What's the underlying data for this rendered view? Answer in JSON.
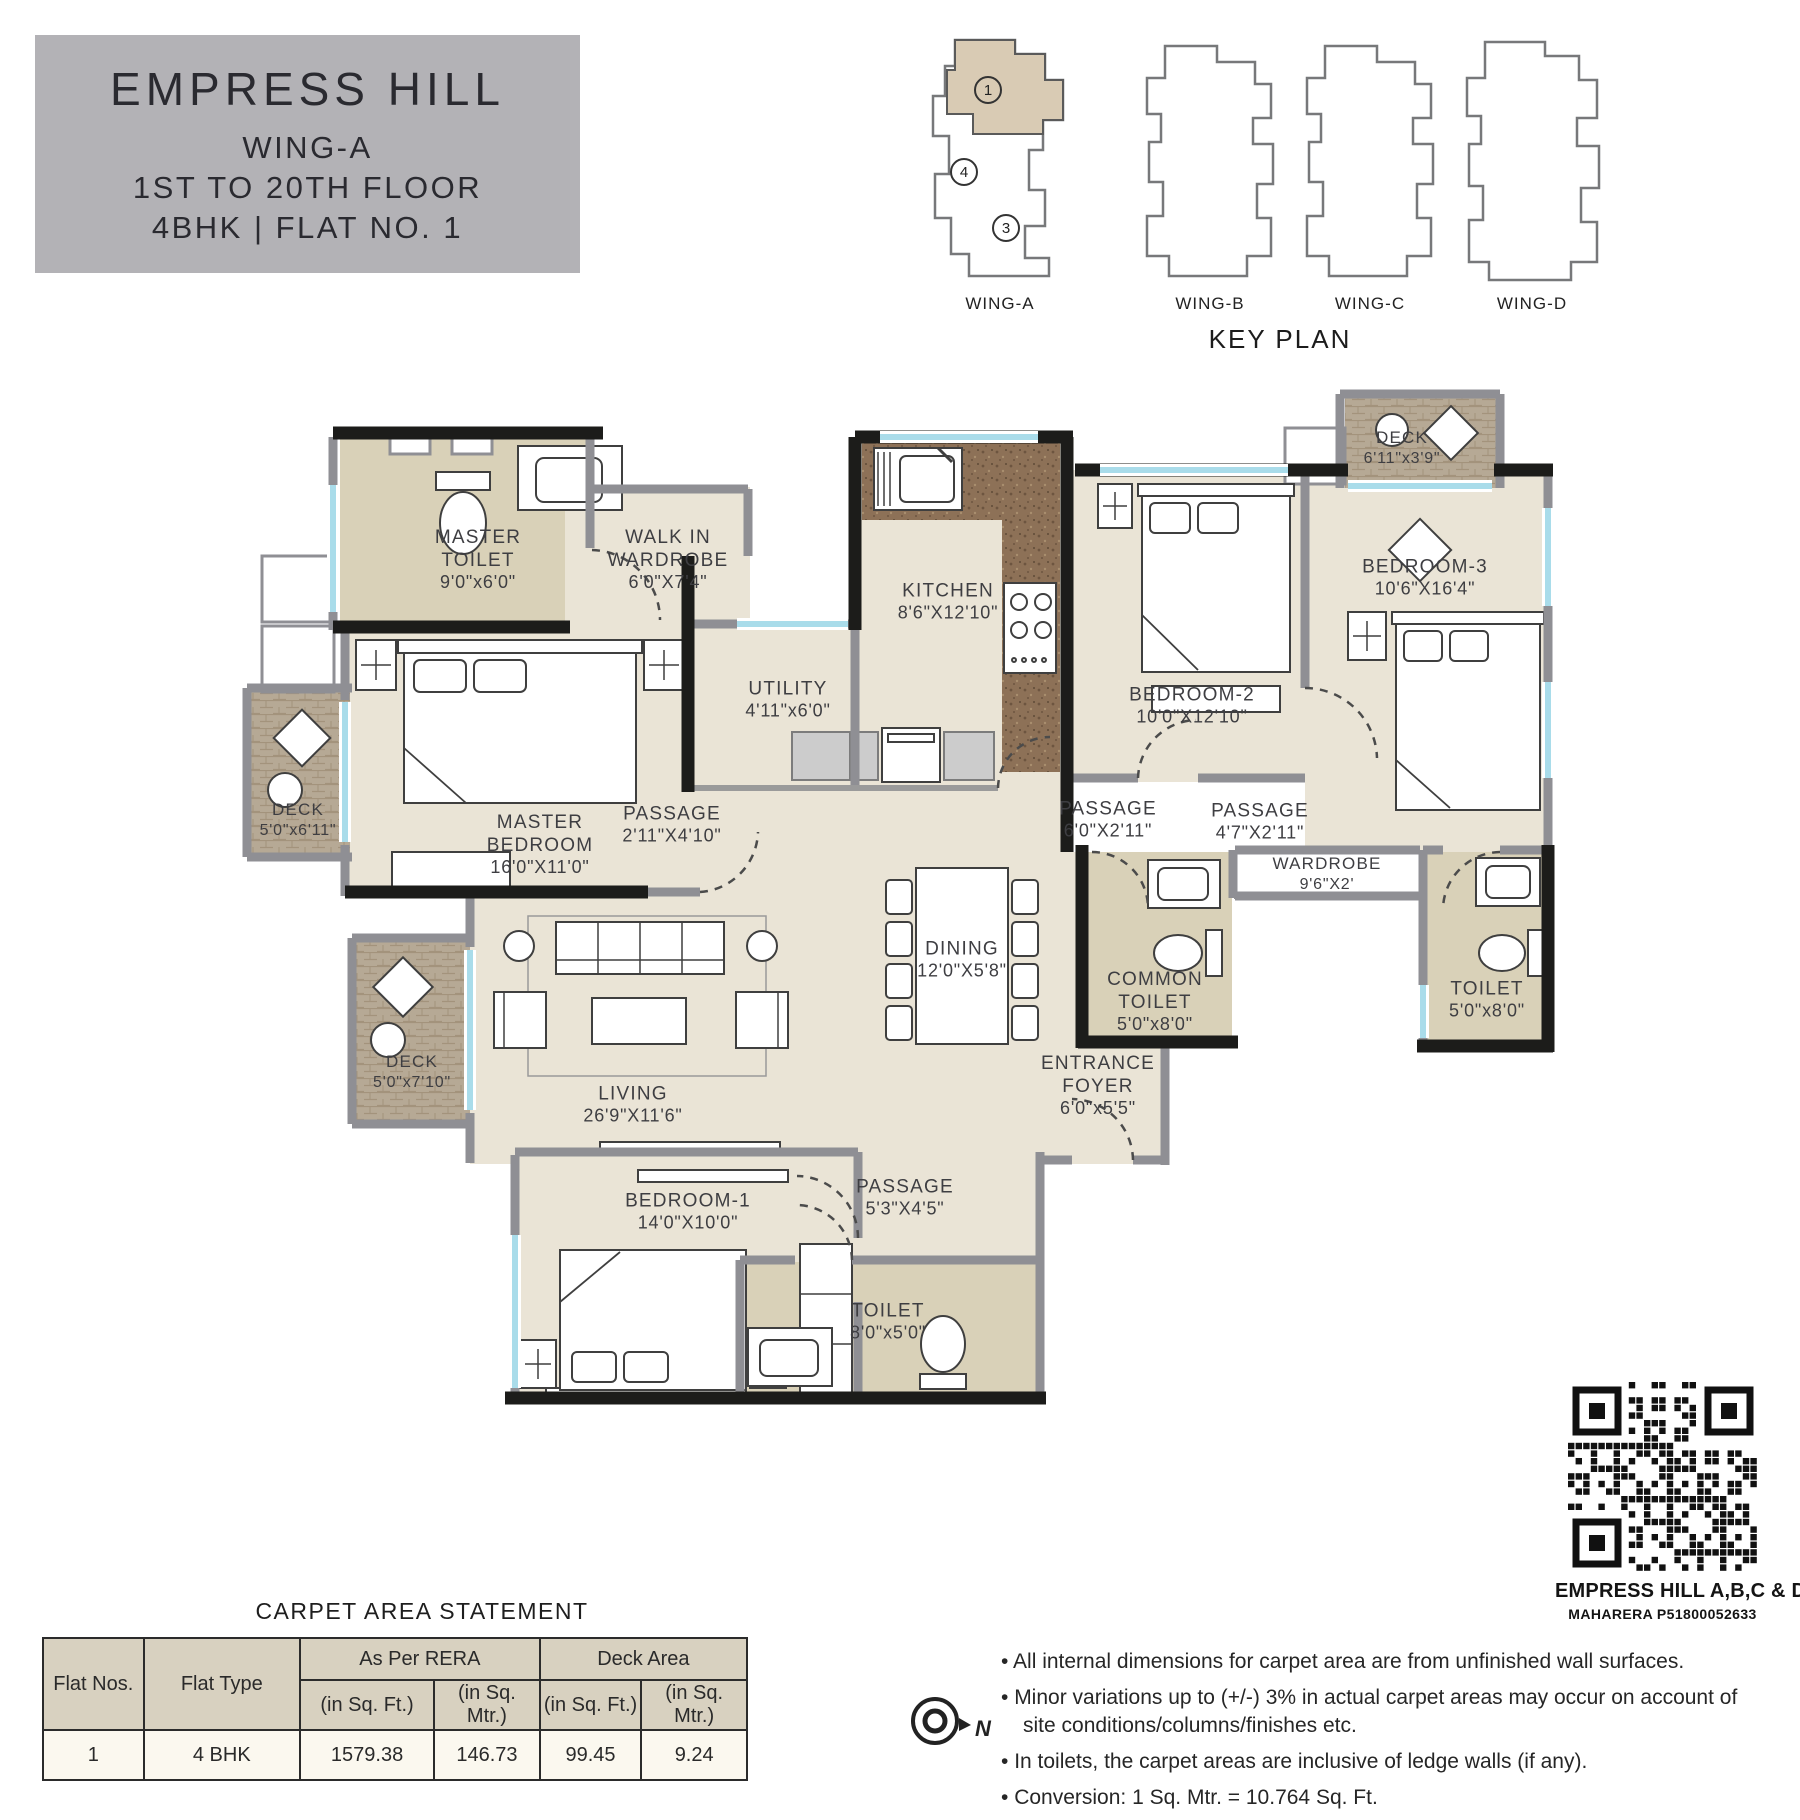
{
  "title_block": {
    "project": "EMPRESS HILL",
    "wing": "WING-A",
    "floors": "1ST TO 20TH FLOOR",
    "unit": "4BHK | FLAT NO. 1"
  },
  "key_plan": {
    "title": "KEY PLAN",
    "wings": [
      "WING-A",
      "WING-B",
      "WING-C",
      "WING-D"
    ],
    "flat_markers": [
      "1",
      "4",
      "3"
    ]
  },
  "floor_plan": {
    "rooms": [
      {
        "name": "MASTER\nTOILET",
        "dim": "9'0\"x6'0\"",
        "cx": 478,
        "cy": 560,
        "small": false
      },
      {
        "name": "WALK IN\nWARDROBE",
        "dim": "6'0\"X7'4\"",
        "cx": 668,
        "cy": 560,
        "small": false
      },
      {
        "name": "KITCHEN",
        "dim": "8'6\"X12'10\"",
        "cx": 948,
        "cy": 602,
        "small": false
      },
      {
        "name": "UTILITY",
        "dim": "4'11\"x6'0\"",
        "cx": 788,
        "cy": 700,
        "small": false
      },
      {
        "name": "DECK",
        "dim": "6'11\"x3'9\"",
        "cx": 1402,
        "cy": 448,
        "small": true
      },
      {
        "name": "BEDROOM-3",
        "dim": "10'6\"X16'4\"",
        "cx": 1425,
        "cy": 578,
        "small": false
      },
      {
        "name": "BEDROOM-2",
        "dim": "10'0\"X12'10\"",
        "cx": 1192,
        "cy": 706,
        "small": false
      },
      {
        "name": "PASSAGE",
        "dim": "2'11\"X4'10\"",
        "cx": 672,
        "cy": 825,
        "small": false
      },
      {
        "name": "PASSAGE",
        "dim": "6'0\"X2'11\"",
        "cx": 1108,
        "cy": 820,
        "small": false
      },
      {
        "name": "PASSAGE",
        "dim": "4'7\"X2'11\"",
        "cx": 1260,
        "cy": 822,
        "small": false
      },
      {
        "name": "WARDROBE",
        "dim": "9'6\"X2'",
        "cx": 1327,
        "cy": 874,
        "small": true
      },
      {
        "name": "MASTER\nBEDROOM",
        "dim": "16'0\"X11'0\"",
        "cx": 540,
        "cy": 845,
        "small": false
      },
      {
        "name": "DECK",
        "dim": "5'0\"x6'11\"",
        "cx": 298,
        "cy": 820,
        "small": true
      },
      {
        "name": "DINING",
        "dim": "12'0\"X5'8\"",
        "cx": 962,
        "cy": 960,
        "small": false
      },
      {
        "name": "COMMON\nTOILET",
        "dim": "5'0\"x8'0\"",
        "cx": 1155,
        "cy": 1002,
        "small": false
      },
      {
        "name": "TOILET",
        "dim": "5'0\"x8'0\"",
        "cx": 1487,
        "cy": 1000,
        "small": false
      },
      {
        "name": "DECK",
        "dim": "5'0\"x7'10\"",
        "cx": 412,
        "cy": 1072,
        "small": true
      },
      {
        "name": "LIVING",
        "dim": "26'9\"X11'6\"",
        "cx": 633,
        "cy": 1105,
        "small": false
      },
      {
        "name": "ENTRANCE\nFOYER",
        "dim": "6'0\"x5'5\"",
        "cx": 1098,
        "cy": 1086,
        "small": false
      },
      {
        "name": "BEDROOM-1",
        "dim": "14'0\"X10'0\"",
        "cx": 688,
        "cy": 1212,
        "small": false
      },
      {
        "name": "PASSAGE",
        "dim": "5'3\"X4'5\"",
        "cx": 905,
        "cy": 1198,
        "small": false
      },
      {
        "name": "TOILET",
        "dim": "8'0\"x5'0\"",
        "cx": 888,
        "cy": 1322,
        "small": false
      }
    ]
  },
  "compass": {
    "label": "N"
  },
  "qr_block": {
    "line1": "EMPRESS HILL A,B,C & D",
    "line2": "MAHARERA P51800052633"
  },
  "carpet_table": {
    "title": "CARPET AREA STATEMENT",
    "col_flat_nos": "Flat Nos.",
    "col_flat_type": "Flat Type",
    "group_rera": "As Per RERA",
    "group_deck": "Deck Area",
    "sub_headers": [
      "(in Sq. Ft.)",
      "(in Sq. Mtr.)",
      "(in Sq. Ft.)",
      "(in Sq. Mtr.)"
    ],
    "rows": [
      {
        "flat_no": "1",
        "flat_type": "4 BHK",
        "rera_sqft": "1579.38",
        "rera_sqmtr": "146.73",
        "deck_sqft": "99.45",
        "deck_sqmtr": "9.24"
      }
    ]
  },
  "notes": [
    "All internal dimensions for carpet area are from unfinished wall surfaces.",
    "Minor variations up to (+/-) 3% in actual carpet areas may occur on account of site conditions/columns/finishes etc.",
    "In toilets, the carpet areas are inclusive of ledge walls (if any).",
    "Conversion: 1 Sq. Mtr. = 10.764 Sq. Ft."
  ],
  "colors": {
    "title_bg": "#b3b2b6",
    "floor_beige": "#eae4d6",
    "floor_tan": "#d9d1b8",
    "wall_black": "#1c1c1a",
    "wall_gray": "#8f8f94",
    "window_blue": "#a9dcea",
    "counter_brown": "#8d7157",
    "table_header_bg": "#d8d1c0",
    "table_row_bg": "#fbf8ef"
  }
}
